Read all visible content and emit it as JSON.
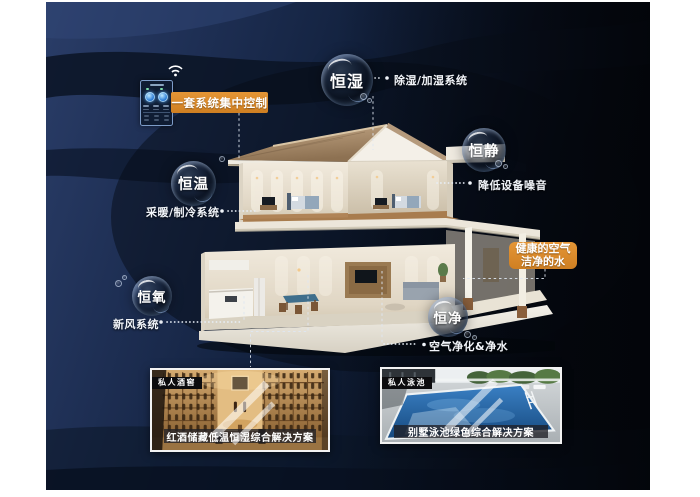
{
  "poster": {
    "control": {
      "label": "一套系统集中控制"
    },
    "bubbles": {
      "humidity": {
        "label": "恒湿",
        "desc": "除湿/加湿系统"
      },
      "quiet": {
        "label": "恒静",
        "desc": "降低设备噪音"
      },
      "temp": {
        "label": "恒温",
        "desc": "采暖/制冷系统"
      },
      "oxygen": {
        "label": "恒氧",
        "desc": "新风系统"
      },
      "purity": {
        "label": "恒净",
        "desc": "空气净化&净水"
      }
    },
    "highlight": {
      "line1": "健康的空气",
      "line2": "洁净的水"
    },
    "cards": {
      "wine": {
        "badge": "私人酒窖",
        "caption": "红酒储藏低温恒湿综合解决方案"
      },
      "pool": {
        "badge": "私人泳池",
        "caption": "别墅泳池绿色综合解决方案"
      }
    },
    "colors": {
      "accent_orange": "#d9872b",
      "background_navy": "#1d2e52",
      "wave_dark": "#0a1424"
    }
  }
}
